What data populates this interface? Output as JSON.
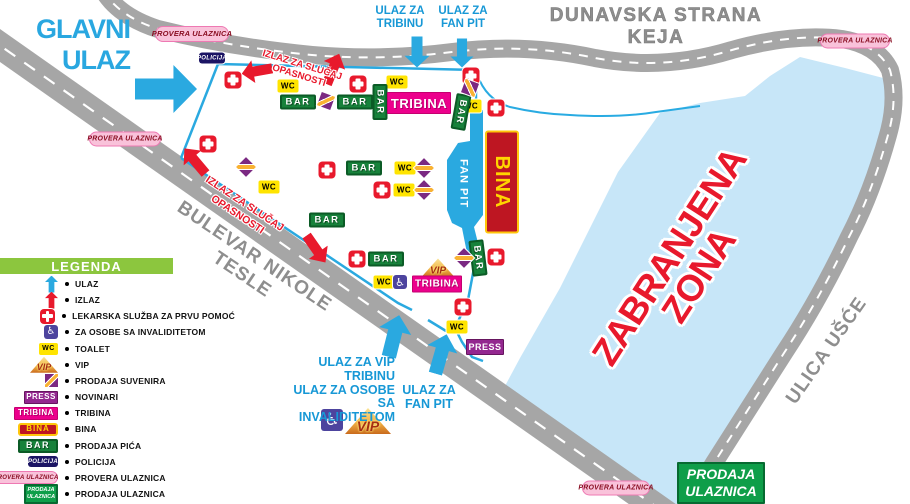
{
  "labels": {
    "glavni": [
      "GLAVNI",
      "ULAZ"
    ],
    "dunavska": "DUNAVSKA STRANA KEJA",
    "bulevar": "BULEVAR NIKOLE TESLE",
    "ulica_usce": "ULICA UŠĆE",
    "zabranjena": [
      "ZABRANJENA",
      "ZONA"
    ],
    "ulaz_tribinu": [
      "ULAZ ZA",
      "TRIBINU"
    ],
    "ulaz_fanpit_top": [
      "ULAZ ZA",
      "FAN PIT"
    ],
    "izlaz_opasnost": [
      "IZLAZ ZA SLUČAJ",
      "OPASNOSTI"
    ],
    "ulaz_vip": [
      "ULAZ ZA VIP TRIBINU",
      "ULAZ ZA OSOBE SA",
      "INVALIDITETOM"
    ],
    "ulaz_fanpit_bottom": [
      "ULAZ ZA",
      "FAN PIT"
    ]
  },
  "badge_labels": {
    "wc": "WC",
    "bar": "BAR",
    "press": "PRESS",
    "tribina": "TRIBINA",
    "bina": "BINA",
    "policija": "POLICIJA",
    "provera": "PROVERA ULAZNICA",
    "prodaja": "PRODAJA\nULAZNICA",
    "vip": "VIP",
    "fanpit": "FAN PIT",
    "wheel": "♿"
  },
  "colors": {
    "blue_arrow": "#2AA9E0",
    "blue_label": "#1798D6",
    "red": "#E8192C",
    "magenta": "#EC008C",
    "bar_green": "#17823B",
    "legend_green": "#8CC63E",
    "ticket_green": "#0E9E49",
    "wc_yellow": "#FFE400",
    "bina_red": "#BE1622",
    "gold_border": "#FFC60B",
    "police_navy": "#1B1464",
    "press_purple": "#93278F",
    "souvenir_purple": "#7B2982",
    "zone_fill": "#C7E6F8",
    "road_gray": "#A6A6A6",
    "road_text_gray": "#8E8E8E"
  },
  "legend": {
    "title": "LEGENDA",
    "items": [
      {
        "icon": "arrow-blue",
        "label": "ULAZ",
        "w": 13,
        "h": 17
      },
      {
        "icon": "arrow-red",
        "label": "IZLAZ",
        "w": 13,
        "h": 17
      },
      {
        "icon": "aid",
        "label": "LEKARSKA SLUŽBA ZA PRVU POMOĆ",
        "w": 15,
        "h": 15
      },
      {
        "icon": "wheel",
        "label": "ZA OSOBE SA INVALIDITETOM",
        "w": 14,
        "h": 14,
        "fs": 10
      },
      {
        "icon": "wc",
        "label": "TOALET",
        "w": 19,
        "h": 12,
        "fs": 7
      },
      {
        "icon": "vip",
        "label": "VIP",
        "w": 28,
        "h": 16,
        "fs": 9
      },
      {
        "icon": "souv",
        "label": "PRODAJA SUVENIRA",
        "w": 13,
        "h": 13
      },
      {
        "icon": "press",
        "label": "NOVINARI",
        "w": 34,
        "h": 13,
        "fs": 8
      },
      {
        "icon": "tribina",
        "label": "TRIBINA",
        "w": 44,
        "h": 13,
        "fs": 8
      },
      {
        "icon": "bina",
        "label": "BINA",
        "w": 40,
        "h": 13,
        "fs": 8
      },
      {
        "icon": "bar",
        "label": "PRODAJA PIĆA",
        "w": 40,
        "h": 14,
        "fs": 9
      },
      {
        "icon": "policija",
        "label": "POLICIJA",
        "w": 30,
        "h": 11,
        "fs": 6
      },
      {
        "icon": "provera",
        "label": "PROVERA ULAZNICA",
        "w": 64,
        "h": 13,
        "fs": 6
      },
      {
        "icon": "prodaja",
        "label": "PRODAJA ULAZNICA",
        "w": 34,
        "h": 20,
        "fs": 5.5
      }
    ]
  },
  "markers": [
    {
      "t": "aid",
      "x": 233,
      "y": 80
    },
    {
      "t": "aid",
      "x": 208,
      "y": 144
    },
    {
      "t": "aid",
      "x": 358,
      "y": 84
    },
    {
      "t": "aid",
      "x": 327,
      "y": 170
    },
    {
      "t": "aid",
      "x": 382,
      "y": 190
    },
    {
      "t": "aid",
      "x": 357,
      "y": 259
    },
    {
      "t": "aid",
      "x": 471,
      "y": 76
    },
    {
      "t": "aid",
      "x": 496,
      "y": 108
    },
    {
      "t": "aid",
      "x": 496,
      "y": 257
    },
    {
      "t": "aid",
      "x": 463,
      "y": 307
    },
    {
      "t": "wc",
      "x": 288,
      "y": 86
    },
    {
      "t": "wc",
      "x": 397,
      "y": 82
    },
    {
      "t": "wc",
      "x": 269,
      "y": 187
    },
    {
      "t": "wc",
      "x": 405,
      "y": 168
    },
    {
      "t": "wc",
      "x": 404,
      "y": 190
    },
    {
      "t": "wc",
      "x": 471,
      "y": 106
    },
    {
      "t": "wc",
      "x": 384,
      "y": 282
    },
    {
      "t": "wc",
      "x": 457,
      "y": 327
    },
    {
      "t": "bar",
      "x": 298,
      "y": 102
    },
    {
      "t": "bar",
      "x": 355,
      "y": 102
    },
    {
      "t": "bar",
      "x": 364,
      "y": 168
    },
    {
      "t": "bar",
      "x": 327,
      "y": 220
    },
    {
      "t": "bar",
      "x": 386,
      "y": 259
    },
    {
      "t": "bar",
      "x": 380,
      "y": 102,
      "r": 90
    },
    {
      "t": "bar",
      "x": 461,
      "y": 112,
      "r": 100
    },
    {
      "t": "bar",
      "x": 478,
      "y": 258,
      "r": 83
    },
    {
      "t": "souv",
      "x": 326,
      "y": 101,
      "r": 20
    },
    {
      "t": "souv",
      "x": 246,
      "y": 167,
      "r": 45
    },
    {
      "t": "souv",
      "x": 424,
      "y": 168,
      "r": 45
    },
    {
      "t": "souv",
      "x": 424,
      "y": 190,
      "r": 45
    },
    {
      "t": "souv",
      "x": 470,
      "y": 88,
      "r": -70
    },
    {
      "t": "souv",
      "x": 464,
      "y": 258,
      "r": 45
    },
    {
      "t": "wheel",
      "x": 400,
      "y": 282,
      "w": 14,
      "h": 14
    },
    {
      "t": "wheel",
      "x": 332,
      "y": 420,
      "w": 22,
      "h": 22,
      "fs": 17
    },
    {
      "t": "vip",
      "x": 438,
      "y": 268,
      "w": 34,
      "h": 19,
      "fs": 10
    },
    {
      "t": "vip",
      "x": 368,
      "y": 421,
      "w": 46,
      "h": 26,
      "fs": 14
    },
    {
      "t": "press",
      "x": 485,
      "y": 347
    },
    {
      "t": "tribina",
      "x": 419,
      "y": 103,
      "w": 64,
      "h": 22,
      "fs": 13
    },
    {
      "t": "tribina",
      "x": 437,
      "y": 284,
      "w": 50,
      "h": 17,
      "fs": 10
    },
    {
      "t": "bina",
      "x": 502,
      "y": 182,
      "w": 34,
      "h": 103,
      "fs": 20,
      "v": 1
    },
    {
      "t": "fanpit",
      "x": 463,
      "y": 184,
      "w": 18,
      "h": 84,
      "fs": 11,
      "v": 1
    },
    {
      "t": "policija",
      "x": 212,
      "y": 58
    },
    {
      "t": "provera",
      "x": 192,
      "y": 34,
      "w": 74,
      "h": 16,
      "fs": 7.5
    },
    {
      "t": "provera",
      "x": 125,
      "y": 139,
      "w": 72,
      "h": 15
    },
    {
      "t": "provera",
      "x": 855,
      "y": 41,
      "w": 70,
      "h": 15
    },
    {
      "t": "provera",
      "x": 616,
      "y": 488,
      "w": 68,
      "h": 15
    },
    {
      "t": "prodaja",
      "x": 721,
      "y": 483
    },
    {
      "t": "arrow-blue",
      "x": 166,
      "y": 89,
      "w": 48,
      "h": 62,
      "r": 90
    },
    {
      "t": "arrow-blue",
      "x": 417,
      "y": 52,
      "w": 25,
      "h": 31,
      "r": 180
    },
    {
      "t": "arrow-blue",
      "x": 462,
      "y": 53,
      "w": 23,
      "h": 29,
      "r": 180
    },
    {
      "t": "arrow-blue",
      "x": 394,
      "y": 336,
      "w": 33,
      "h": 43,
      "r": 14
    },
    {
      "t": "arrow-blue",
      "x": 441,
      "y": 354,
      "w": 31,
      "h": 41,
      "r": 16
    },
    {
      "t": "arrow-red",
      "x": 257,
      "y": 71,
      "r": -100
    },
    {
      "t": "arrow-red",
      "x": 333,
      "y": 69,
      "w": 23,
      "h": 33,
      "r": 22
    },
    {
      "t": "arrow-red",
      "x": 195,
      "y": 161,
      "w": 23,
      "h": 33,
      "r": -40
    },
    {
      "t": "arrow-red",
      "x": 316,
      "y": 249,
      "w": 23,
      "h": 33,
      "r": 145
    }
  ]
}
